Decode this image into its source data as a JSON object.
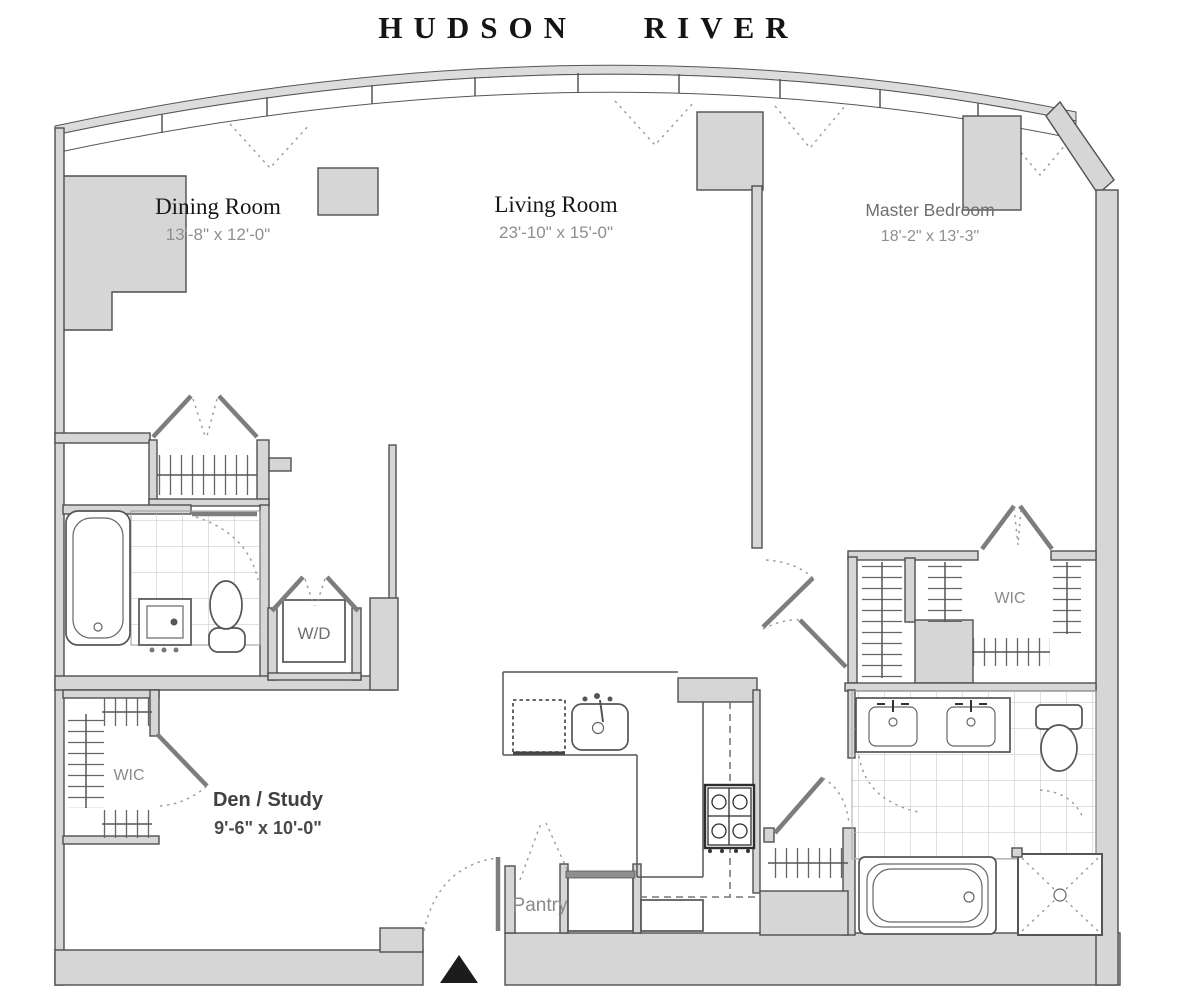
{
  "title": "HUDSON RIVER",
  "rooms": {
    "dining": {
      "name": "Dining Room",
      "dims": "13'-8\" x 12'-0\""
    },
    "living": {
      "name": "Living Room",
      "dims": "23'-10\" x 15'-0\""
    },
    "master_bedroom": {
      "name": "Master Bedroom",
      "dims": "18'-2\" x 13'-3\""
    },
    "den": {
      "name": "Den / Study",
      "dims": "9'-6\" x 10'-0\""
    },
    "wic_left": {
      "name": "WIC"
    },
    "wic_right": {
      "name": "WIC"
    },
    "laundry": {
      "name": "W/D"
    },
    "pantry": {
      "name": "Pantry"
    }
  },
  "colors": {
    "background": "#ffffff",
    "wall_fill": "#d6d6d6",
    "wall_stroke": "#4f4f4f",
    "window_band": "#dcdcdc",
    "serif_label": "#161616",
    "dim_text": "#8f8f8f",
    "gray_label": "#8a8a8a",
    "den_label": "#414141",
    "dash": "#9a9a9a",
    "entry_marker": "#1c1c1c"
  }
}
